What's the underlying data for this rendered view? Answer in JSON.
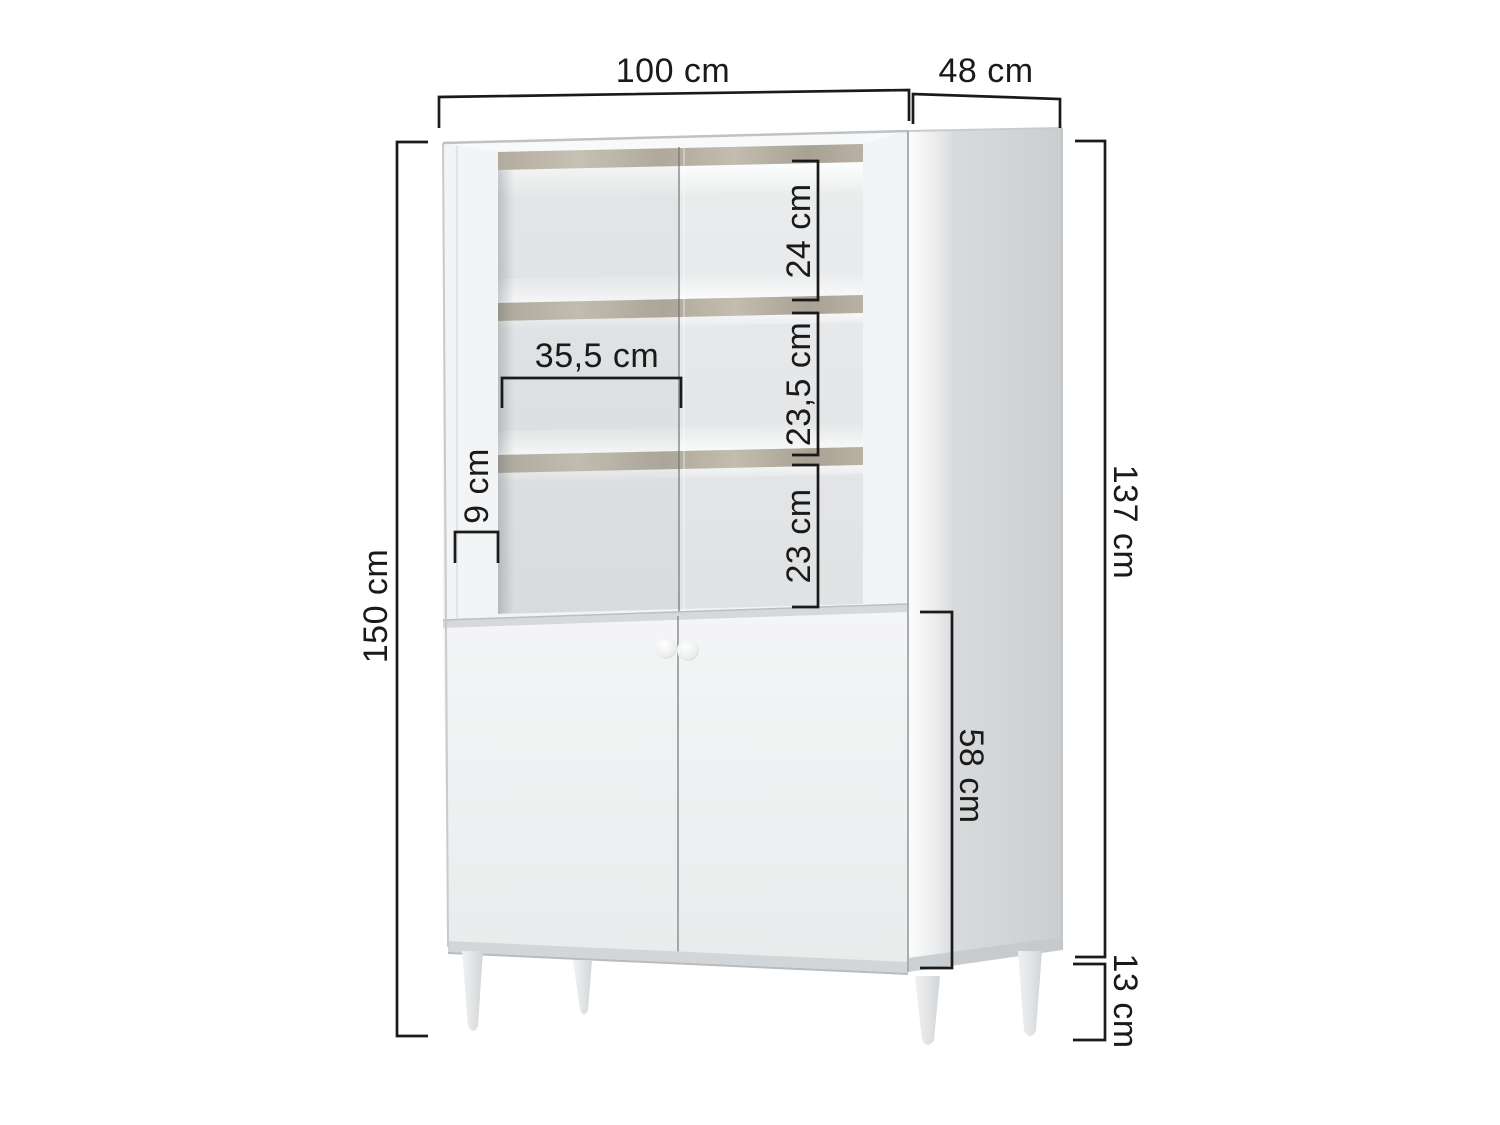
{
  "page": {
    "background_color": "#ffffff",
    "content_type": "furniture dimension diagram"
  },
  "diagram": {
    "subject": "display cabinet with two glass doors, interior shelves, two-door base cabinet and tapered legs",
    "unit": "cm",
    "colors": {
      "dimension_line": "#1a1a1a",
      "label_text": "#1a1a1a",
      "cabinet_front": "#f4f5f6",
      "cabinet_side": "#d2d4d6",
      "shelf_wood": "#bab3a6",
      "interior_back": "#e4e6e7"
    }
  },
  "dims": {
    "width": "100 cm",
    "depth": "48 cm",
    "total_height": "150 cm",
    "body_height": "137 cm",
    "leg_height": "13 cm",
    "door_section_height": "58 cm",
    "top_compartment_height": "24 cm",
    "middle_compartment_height": "23,5 cm",
    "bottom_compartment_height": "23 cm",
    "compartment_inner_width": "35,5 cm",
    "side_frame_width": "9 cm"
  }
}
